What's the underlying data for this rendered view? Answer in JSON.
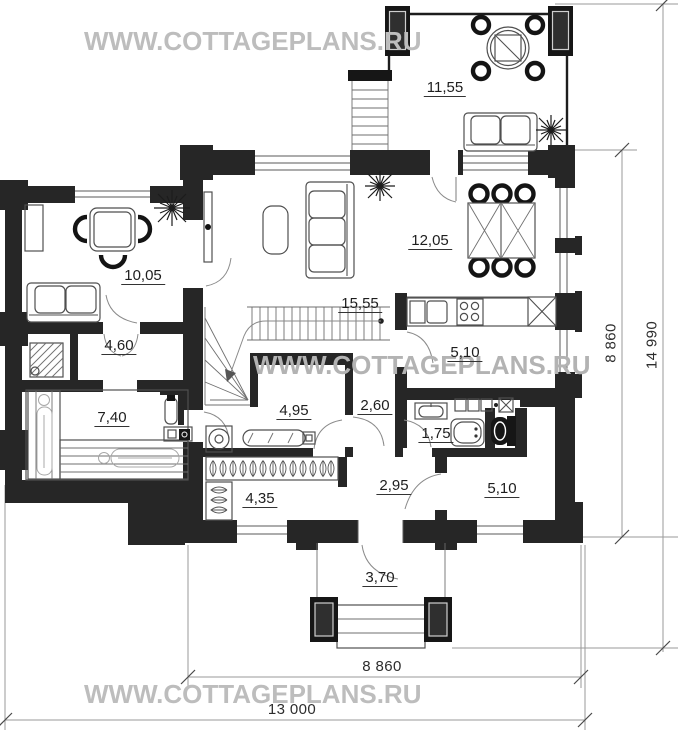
{
  "watermarks": {
    "top": "WWW.COTTAGEPLANS.RU",
    "middle": "WWW.COTTAGEPLANS.RU",
    "bottom": "WWW.COTTAGEPLANS.RU"
  },
  "room_areas": {
    "terrace": "11,55",
    "guest_room": "10,05",
    "living_room": "15,55",
    "dining_area": "12,05",
    "hall": "4,60",
    "sauna": "7,40",
    "laundry": "4,95",
    "hallway": "2,60",
    "kitchen": "5,10",
    "bathroom": "1,75",
    "corridor": "2,95",
    "bedroom": "5,10",
    "entry": "4,35",
    "porch": "3,70"
  },
  "dimensions": {
    "right_inner": "8 860",
    "right_outer": "14 990",
    "bottom_inner": "8 860",
    "bottom_outer": "13 000"
  },
  "colors": {
    "wall": "#262626",
    "furniture_line": "#4f4f4f",
    "label": "#1e1e1e",
    "dimension_line": "#9a9a9a",
    "watermark": "#bdbdbd"
  }
}
